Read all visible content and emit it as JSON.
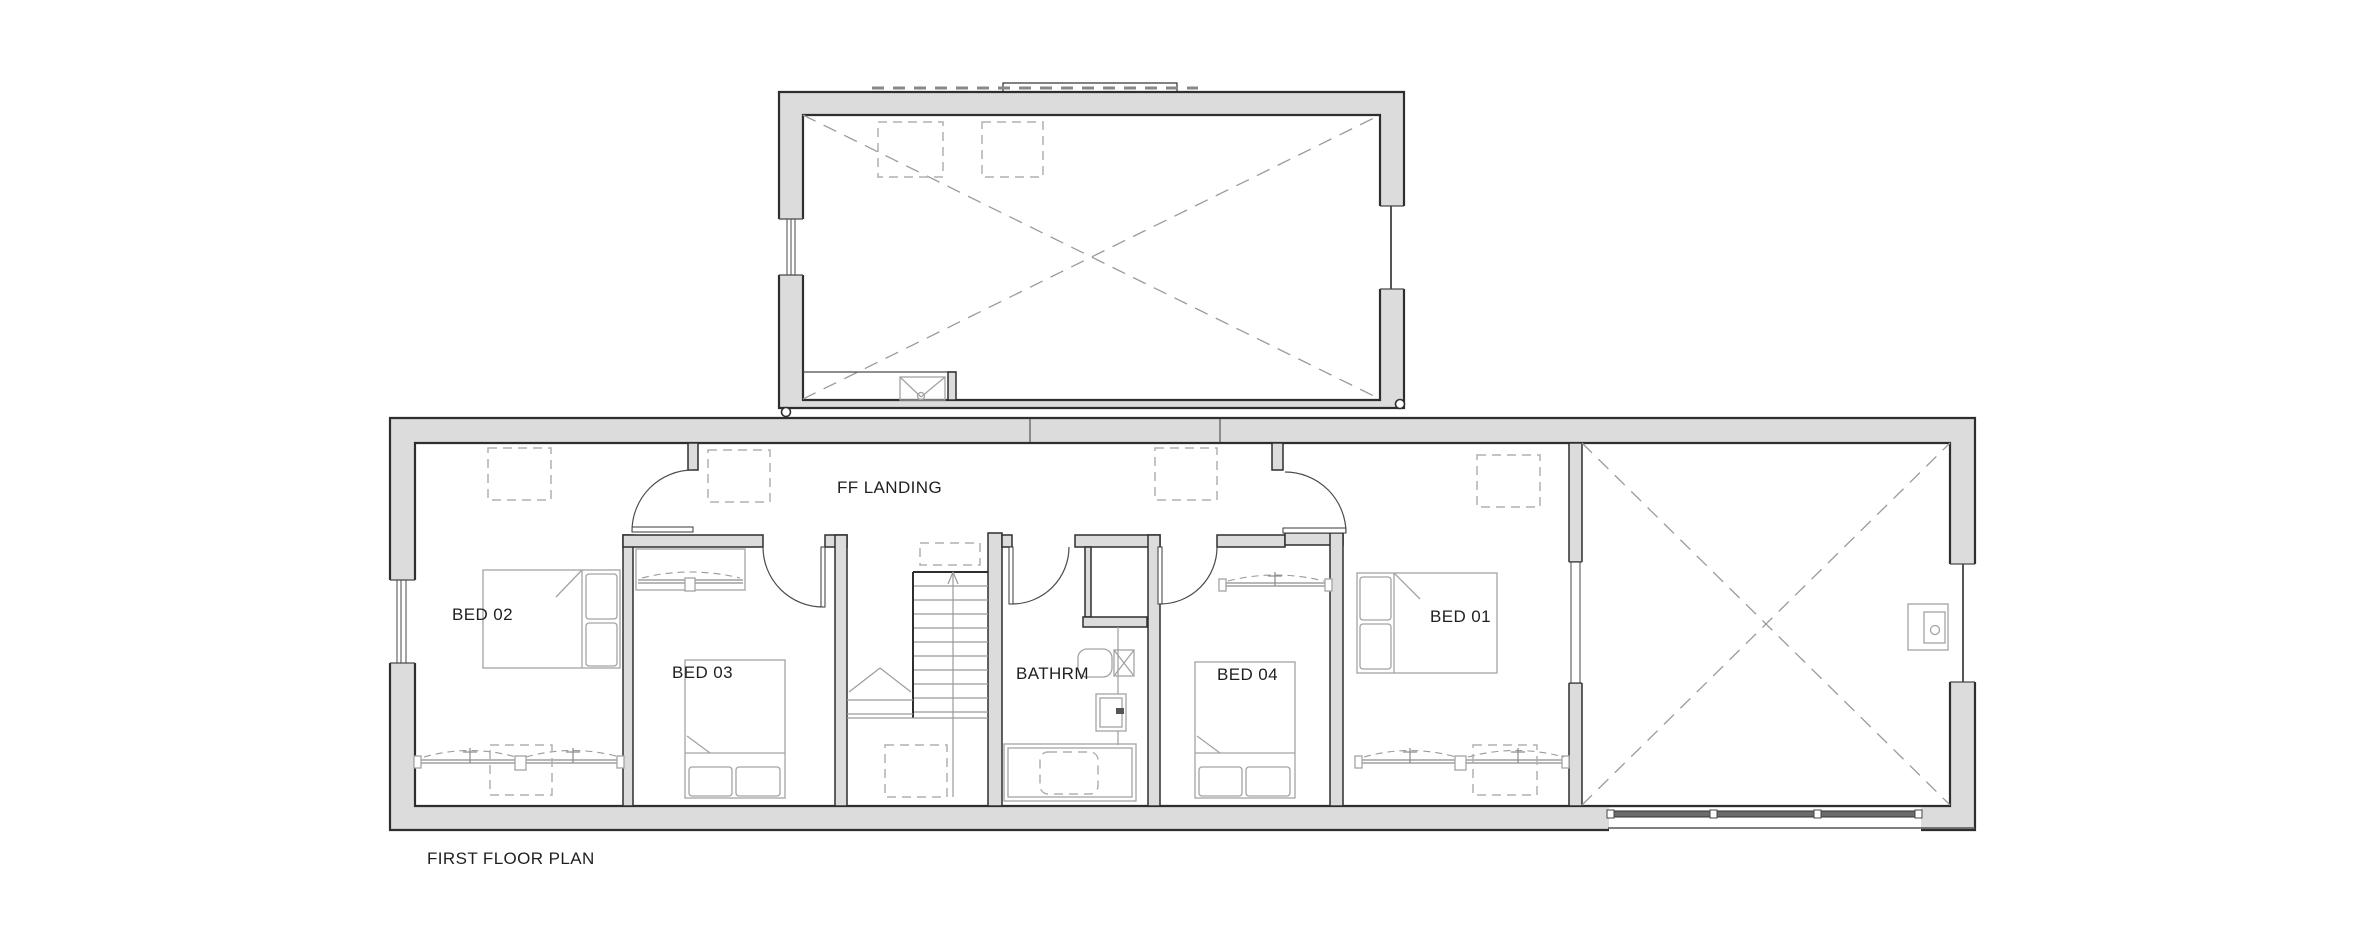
{
  "drawing": {
    "title": "FIRST FLOOR PLAN",
    "labels": {
      "landing": "FF LANDING",
      "bed01": "BED 01",
      "bed02": "BED 02",
      "bed03": "BED 03",
      "bed04": "BED 04",
      "bathroom": "BATHRM"
    },
    "colors": {
      "wall_fill": "#dcdcdc",
      "wall_line": "#2e2e2e",
      "furniture_line": "#a3a3a3",
      "dashed_line": "#9a9a9a",
      "text": "#1f1f1f",
      "background": "#ffffff"
    }
  }
}
